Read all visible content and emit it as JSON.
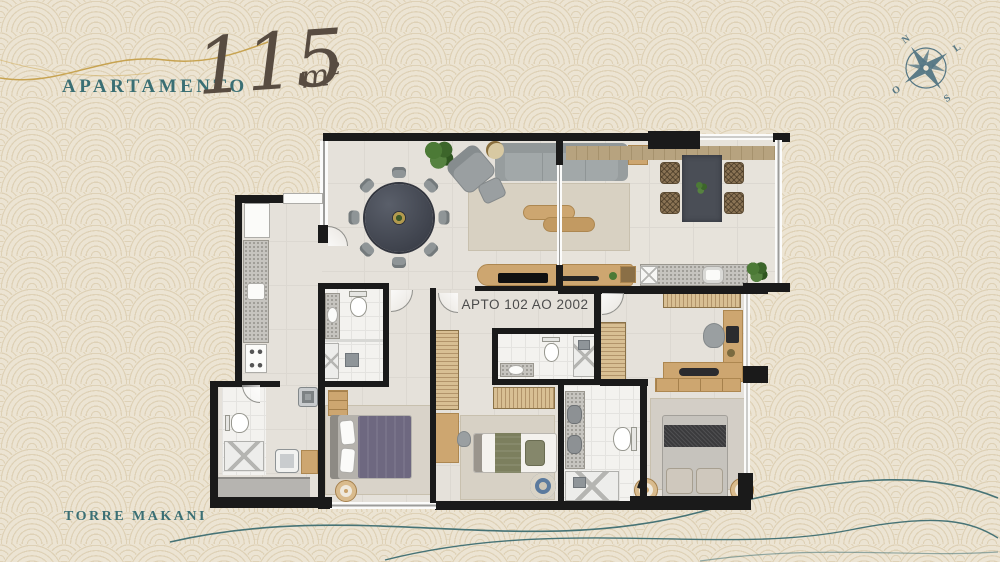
{
  "header": {
    "title": "APARTAMENTO",
    "area_value": "115",
    "area_unit": "m²"
  },
  "compass": {
    "n": "N",
    "e": "L",
    "s": "S",
    "o": "O"
  },
  "floorplan": {
    "unit_label": "APTO 102 AO 2002"
  },
  "footer": {
    "tower": "TORRE MAKANI"
  },
  "colors": {
    "background": "#ece4d3",
    "pattern_ring": "#ded1b6",
    "accent_teal": "#3a6f74",
    "script_brown": "#584c41",
    "wall_black": "#1a1a1a",
    "wood": "#cda670",
    "gold_line": "#c7a351",
    "wave_line": "#467376"
  }
}
